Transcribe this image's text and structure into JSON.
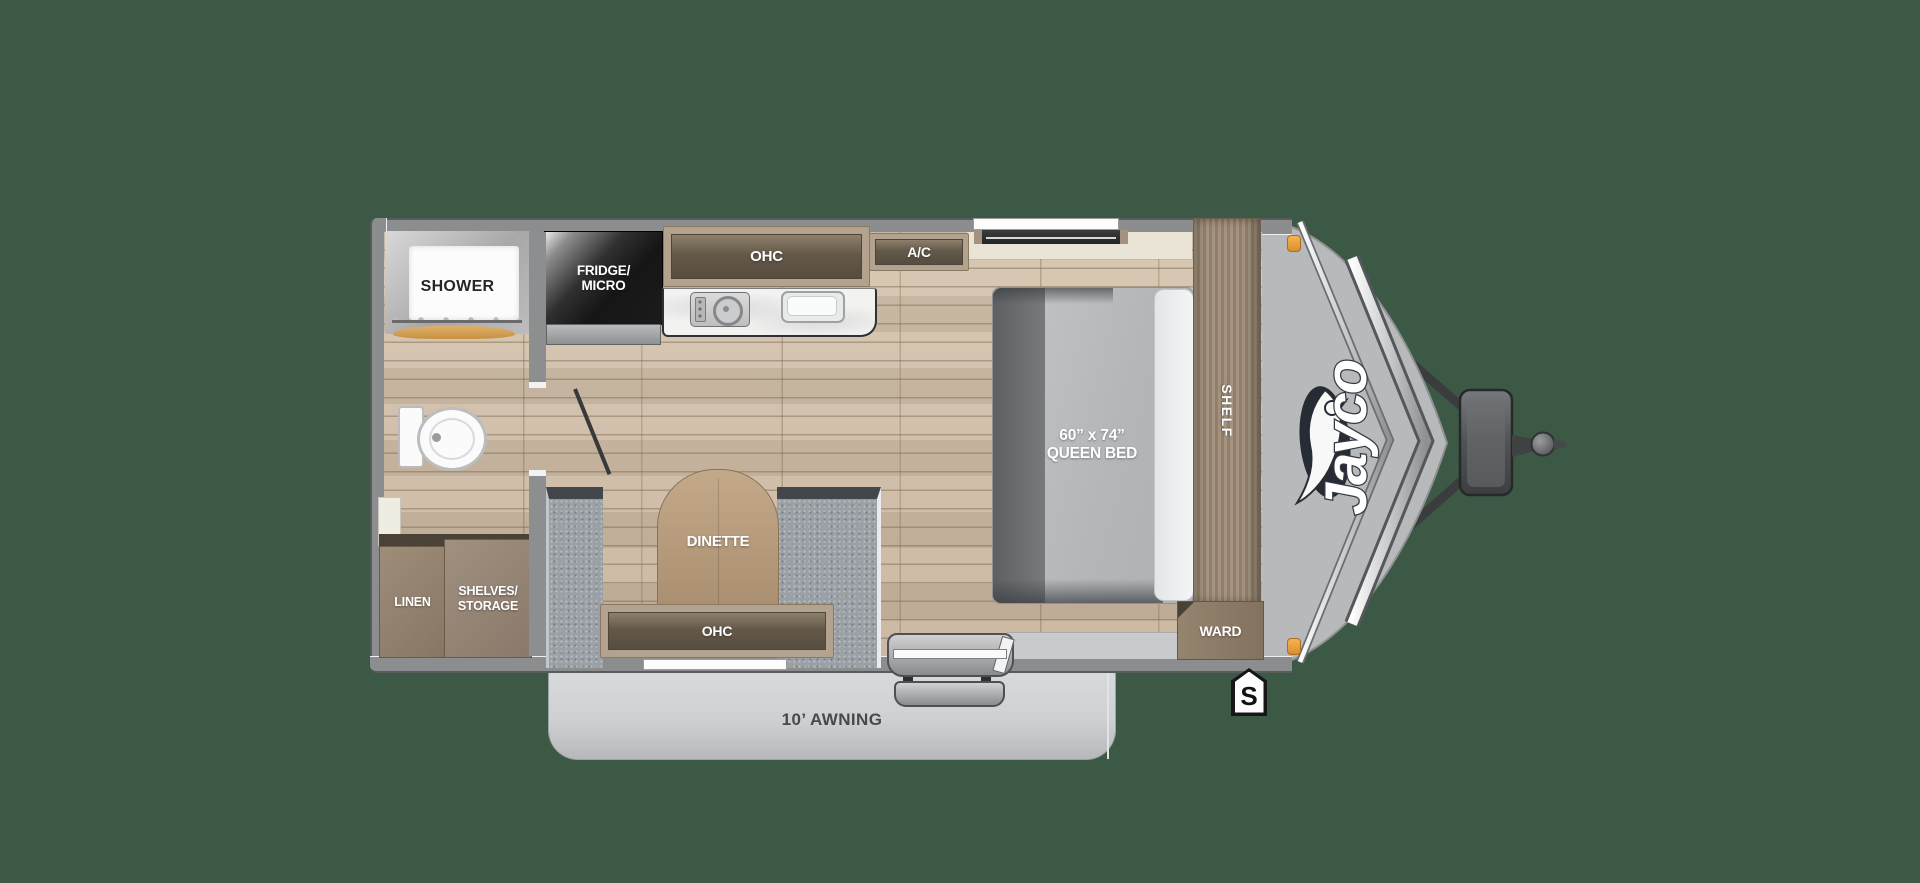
{
  "title": "Jayco travel trailer floor plan",
  "brand": "Jayco",
  "colors": {
    "background": "#3b5945",
    "wall_gray": "#8b8d8f",
    "wood_floor": "#cdbba6",
    "cabinet_frame": "#b3a28d",
    "cabinet_panel": "#645949",
    "bench_gray": "#9aa0a5",
    "mattress_gray": "#b9bcbe",
    "counter_white": "#f2f2f0",
    "awning_gray": "#cfd0d2",
    "amber_light": "#f0a43c",
    "fridge_black": "#161616"
  },
  "rooms": {
    "bathroom": {
      "shower": "SHOWER"
    },
    "kitchen": {
      "fridge_line1": "FRIDGE/",
      "fridge_line2": "MICRO",
      "overhead_cabinet": "OHC",
      "air_conditioner": "A/C"
    },
    "bedroom": {
      "bed_line1": "60” x 74”",
      "bed_line2": "QUEEN BED",
      "shelf": "SHELF",
      "wardrobe": "WARD"
    },
    "dinette": {
      "label": "DINETTE",
      "overhead_cabinet": "OHC"
    },
    "storage": {
      "linen": "LINEN",
      "shelves_line1": "SHELVES/",
      "shelves_line2": "STORAGE"
    }
  },
  "exterior": {
    "awning": "10’ AWNING",
    "spare_marker": "S"
  }
}
